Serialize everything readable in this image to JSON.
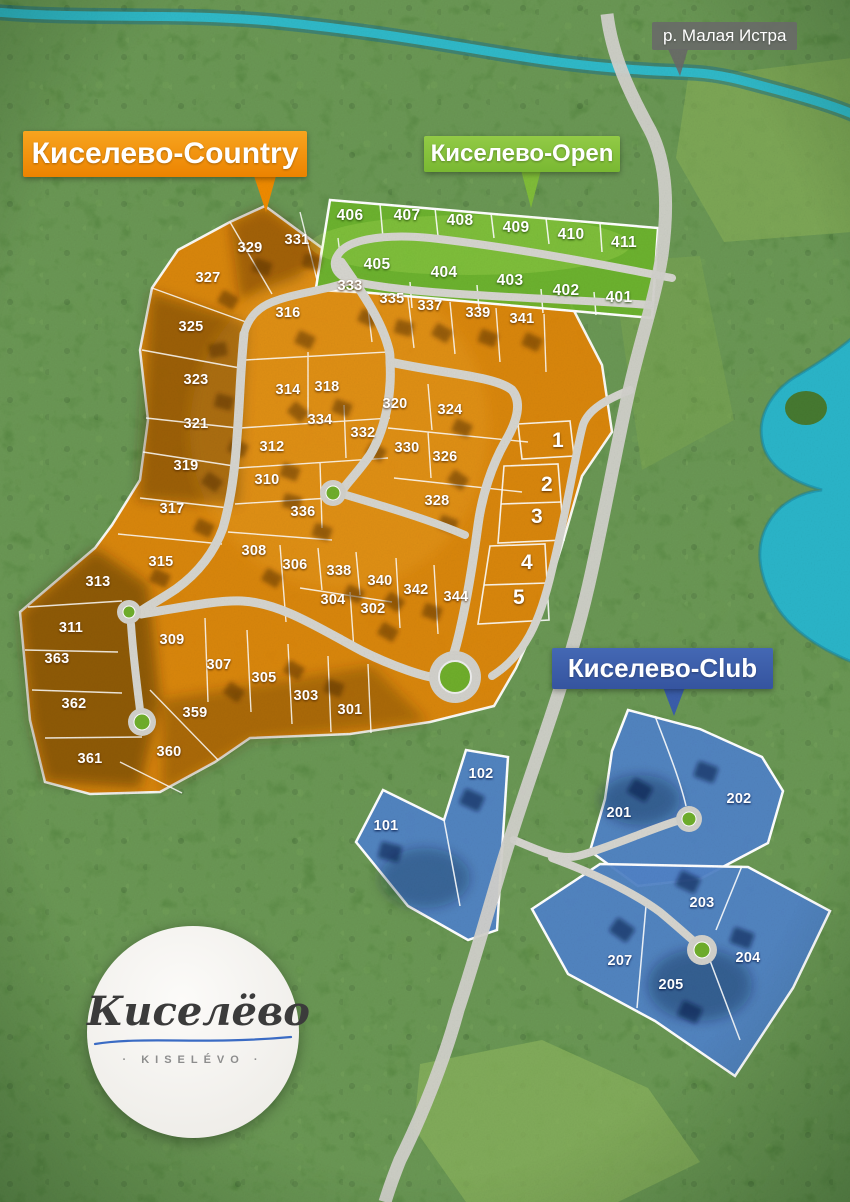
{
  "callouts": {
    "country": {
      "label": "Киселево-Country",
      "color": "#ee8a00"
    },
    "open": {
      "label": "Киселево-Open",
      "color": "#7fbc38"
    },
    "club": {
      "label": "Киселево-Club",
      "color": "#3a5dab"
    },
    "river": {
      "label": "р. Малая Истра",
      "color": "#696969"
    }
  },
  "logo": {
    "title": "Киселёво",
    "subtitle": "· KISELÉVO ·"
  },
  "colors": {
    "country_zone": "#e08507",
    "open_zone": "#6cb32d",
    "club_zone": "#5083c6",
    "road": "#d2d1cb",
    "water": "#2fbccd",
    "roundabout_green": "#6fae2b"
  },
  "zones": [
    {
      "id": "country",
      "name": "Киселево-Country",
      "plots": [
        {
          "n": "329",
          "x": 250,
          "y": 248
        },
        {
          "n": "331",
          "x": 297,
          "y": 240
        },
        {
          "n": "327",
          "x": 208,
          "y": 278
        },
        {
          "n": "325",
          "x": 191,
          "y": 327
        },
        {
          "n": "323",
          "x": 196,
          "y": 380
        },
        {
          "n": "321",
          "x": 196,
          "y": 424
        },
        {
          "n": "319",
          "x": 186,
          "y": 466
        },
        {
          "n": "317",
          "x": 172,
          "y": 509
        },
        {
          "n": "315",
          "x": 161,
          "y": 562
        },
        {
          "n": "313",
          "x": 98,
          "y": 582
        },
        {
          "n": "311",
          "x": 71,
          "y": 628
        },
        {
          "n": "363",
          "x": 57,
          "y": 659
        },
        {
          "n": "362",
          "x": 74,
          "y": 704
        },
        {
          "n": "361",
          "x": 90,
          "y": 759
        },
        {
          "n": "316",
          "x": 288,
          "y": 313
        },
        {
          "n": "314",
          "x": 288,
          "y": 390
        },
        {
          "n": "318",
          "x": 327,
          "y": 387
        },
        {
          "n": "334",
          "x": 320,
          "y": 420
        },
        {
          "n": "332",
          "x": 363,
          "y": 433
        },
        {
          "n": "312",
          "x": 272,
          "y": 447
        },
        {
          "n": "310",
          "x": 267,
          "y": 480
        },
        {
          "n": "336",
          "x": 303,
          "y": 512
        },
        {
          "n": "308",
          "x": 254,
          "y": 551
        },
        {
          "n": "306",
          "x": 295,
          "y": 565
        },
        {
          "n": "338",
          "x": 339,
          "y": 571
        },
        {
          "n": "340",
          "x": 380,
          "y": 581
        },
        {
          "n": "342",
          "x": 416,
          "y": 590
        },
        {
          "n": "344",
          "x": 456,
          "y": 597
        },
        {
          "n": "304",
          "x": 333,
          "y": 600
        },
        {
          "n": "302",
          "x": 373,
          "y": 609
        },
        {
          "n": "320",
          "x": 395,
          "y": 404
        },
        {
          "n": "324",
          "x": 450,
          "y": 410
        },
        {
          "n": "330",
          "x": 407,
          "y": 448
        },
        {
          "n": "326",
          "x": 445,
          "y": 457
        },
        {
          "n": "328",
          "x": 437,
          "y": 501
        },
        {
          "n": "333",
          "x": 350,
          "y": 286
        },
        {
          "n": "335",
          "x": 392,
          "y": 299
        },
        {
          "n": "337",
          "x": 430,
          "y": 306
        },
        {
          "n": "339",
          "x": 478,
          "y": 313
        },
        {
          "n": "341",
          "x": 522,
          "y": 319
        },
        {
          "n": "309",
          "x": 172,
          "y": 640
        },
        {
          "n": "307",
          "x": 219,
          "y": 665
        },
        {
          "n": "359",
          "x": 195,
          "y": 713
        },
        {
          "n": "360",
          "x": 169,
          "y": 752
        },
        {
          "n": "305",
          "x": 264,
          "y": 678
        },
        {
          "n": "303",
          "x": 306,
          "y": 696
        },
        {
          "n": "301",
          "x": 350,
          "y": 710
        },
        {
          "n": "1",
          "x": 558,
          "y": 441,
          "big": true
        },
        {
          "n": "2",
          "x": 547,
          "y": 485,
          "big": true
        },
        {
          "n": "3",
          "x": 537,
          "y": 517,
          "big": true
        },
        {
          "n": "4",
          "x": 527,
          "y": 563,
          "big": true
        },
        {
          "n": "5",
          "x": 519,
          "y": 598,
          "big": true
        }
      ]
    },
    {
      "id": "open",
      "name": "Киселево-Open",
      "plots": [
        {
          "n": "406",
          "x": 350,
          "y": 216
        },
        {
          "n": "407",
          "x": 407,
          "y": 216
        },
        {
          "n": "408",
          "x": 460,
          "y": 221
        },
        {
          "n": "409",
          "x": 516,
          "y": 228
        },
        {
          "n": "410",
          "x": 571,
          "y": 235
        },
        {
          "n": "411",
          "x": 624,
          "y": 243
        },
        {
          "n": "405",
          "x": 377,
          "y": 265
        },
        {
          "n": "404",
          "x": 444,
          "y": 273
        },
        {
          "n": "403",
          "x": 510,
          "y": 281
        },
        {
          "n": "402",
          "x": 566,
          "y": 291
        },
        {
          "n": "401",
          "x": 619,
          "y": 298
        }
      ]
    },
    {
      "id": "club",
      "name": "Киселево-Club",
      "plots": [
        {
          "n": "102",
          "x": 481,
          "y": 774
        },
        {
          "n": "101",
          "x": 386,
          "y": 826
        },
        {
          "n": "201",
          "x": 619,
          "y": 813
        },
        {
          "n": "202",
          "x": 739,
          "y": 799
        },
        {
          "n": "203",
          "x": 702,
          "y": 903
        },
        {
          "n": "204",
          "x": 748,
          "y": 958
        },
        {
          "n": "205",
          "x": 671,
          "y": 985
        },
        {
          "n": "207",
          "x": 620,
          "y": 961
        }
      ]
    }
  ]
}
